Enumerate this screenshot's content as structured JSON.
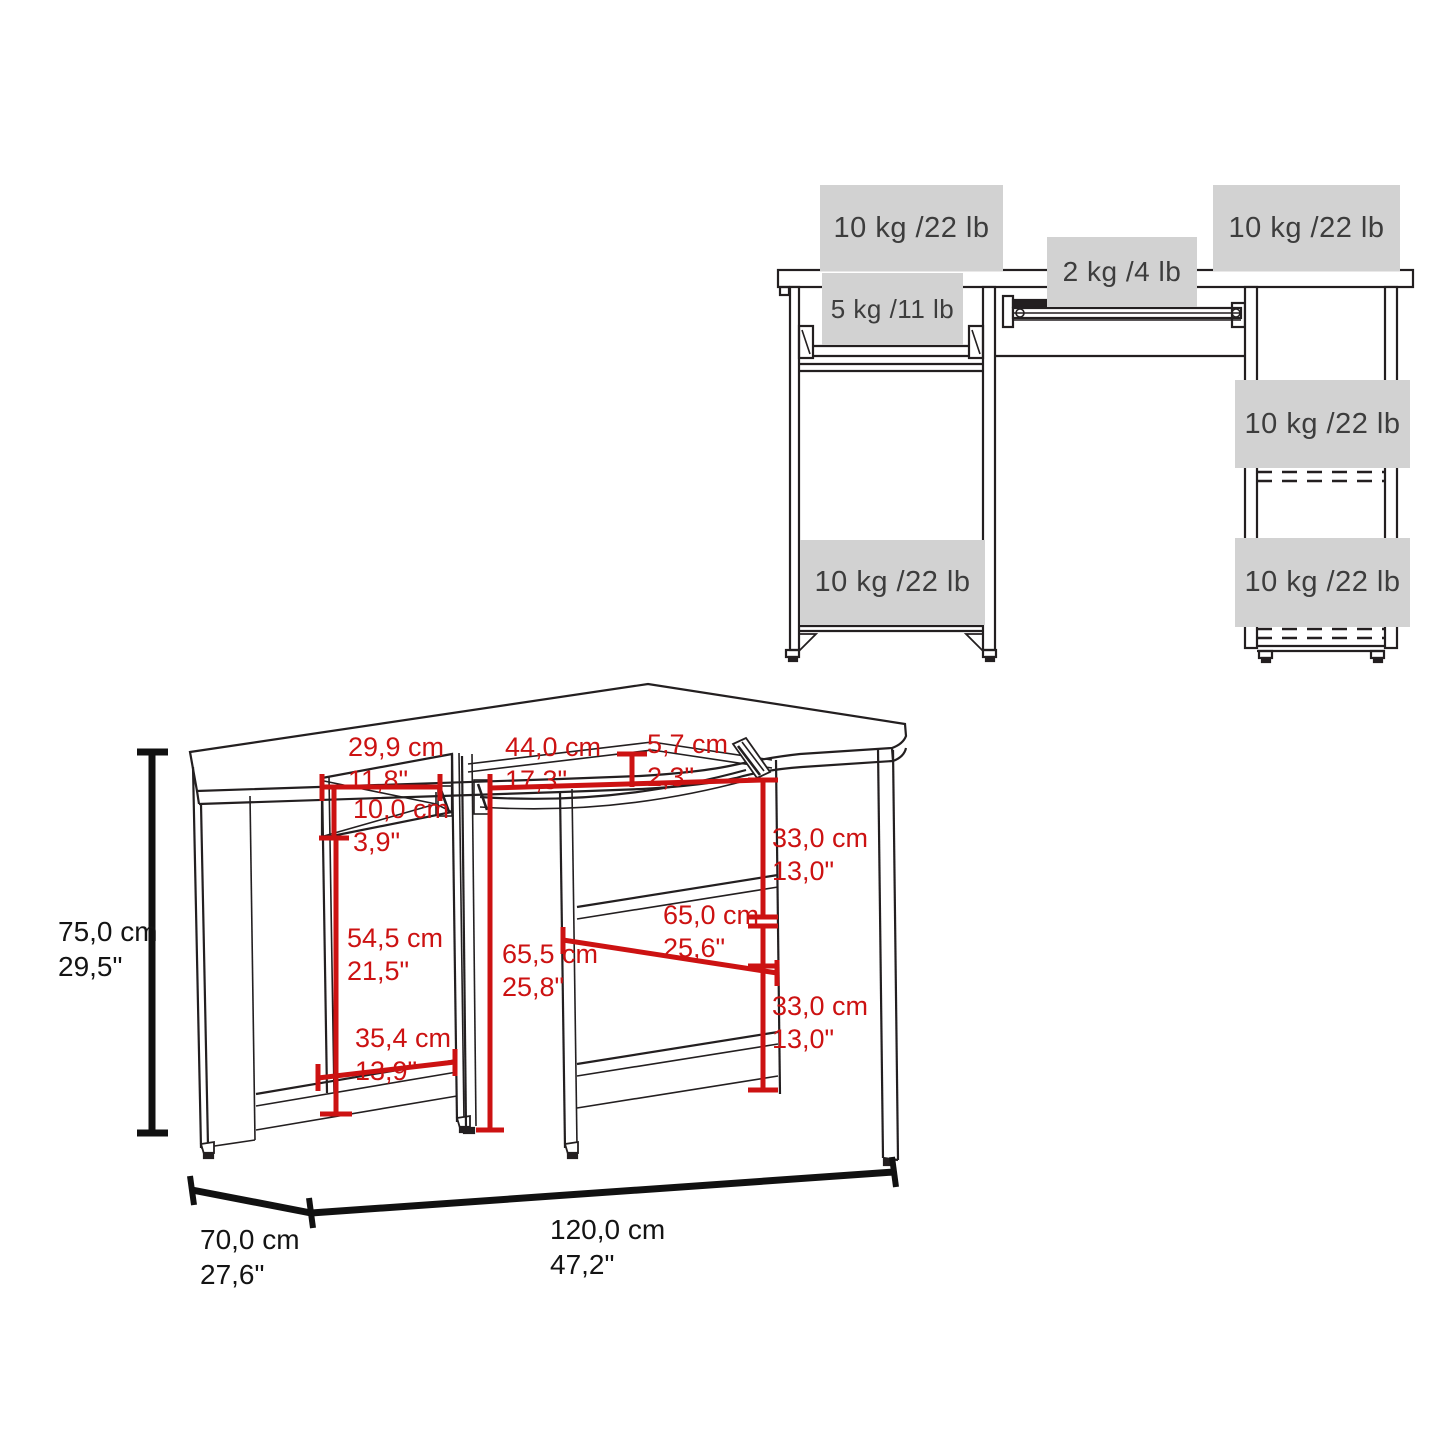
{
  "page": {
    "background": "#ffffff"
  },
  "colors": {
    "dimension_red": "#cc1212",
    "weight_box_gray": "#d2d2d2",
    "line_black": "#231f20",
    "weight_text_gray": "#3d3d3d"
  },
  "front_view": {
    "weights": {
      "desktop_left": "10 kg /22 lb",
      "keyboard_tray_center": "2 kg /4 lb",
      "desktop_right": "10 kg /22 lb",
      "keyboard_tray_left": "5 kg /11 lb",
      "right_shelf_upper": "10 kg /22 lb",
      "left_shelf_bottom": "10 kg /22 lb",
      "right_shelf_bottom": "10 kg /22 lb"
    }
  },
  "perspective_view": {
    "dimensions": {
      "tray_left_width": {
        "cm": "29,9 cm",
        "inch": "11,8\""
      },
      "tray_left_height": {
        "cm": "10,0 cm",
        "inch": "3,9\""
      },
      "tray_center_width": {
        "cm": "44,0 cm",
        "inch": "17,3\""
      },
      "desk_edge_height": {
        "cm": "5,7 cm",
        "inch": "2,3\""
      },
      "right_upper_shelf_height": {
        "cm": "33,0 cm",
        "inch": "13,0\""
      },
      "right_shelf_width": {
        "cm": "65,0 cm",
        "inch": "25,6\""
      },
      "under_desk_height": {
        "cm": "65,5 cm",
        "inch": "25,8\""
      },
      "left_compartment_height": {
        "cm": "54,5 cm",
        "inch": "21,5\""
      },
      "right_lower_shelf_height": {
        "cm": "33,0 cm",
        "inch": "13,0\""
      },
      "left_compartment_width": {
        "cm": "35,4 cm",
        "inch": "13,9\""
      },
      "overall_height": {
        "cm": "75,0 cm",
        "inch": "29,5\""
      },
      "overall_depth": {
        "cm": "70,0 cm",
        "inch": "27,6\""
      },
      "overall_width": {
        "cm": "120,0 cm",
        "inch": "47,2\""
      }
    }
  }
}
